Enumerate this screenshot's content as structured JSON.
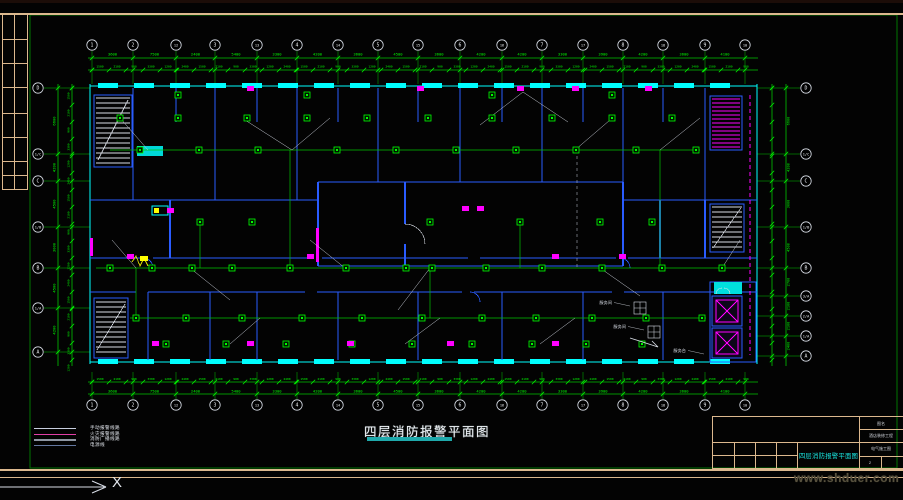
{
  "sheet": {
    "main_title": "四层消防报警平面图",
    "ucs_axis_label": "X",
    "watermark": "www.shduer.com"
  },
  "legend": {
    "items": [
      {
        "label": "手动报警线路",
        "color": "#c7cede"
      },
      {
        "label": "火灾报警线路",
        "color": "#e23fa6"
      },
      {
        "label": "消防广播线路",
        "color": "#8e96a2"
      },
      {
        "label": "电源线",
        "color": "#63779f"
      }
    ]
  },
  "grid": {
    "top": [
      "1",
      "2",
      "12",
      "3",
      "13",
      "4",
      "14",
      "5",
      "15",
      "6",
      "16",
      "7",
      "17",
      "8",
      "18",
      "9",
      "10"
    ],
    "bottom": [
      "1",
      "2",
      "12",
      "3",
      "13",
      "4",
      "14",
      "5",
      "15",
      "6",
      "16",
      "7",
      "17",
      "8",
      "18",
      "9",
      "10"
    ],
    "left": [
      "D",
      "1/C",
      "C",
      "1/B",
      "B",
      "1/A",
      "A"
    ],
    "right": [
      "D",
      "1/C",
      "C",
      "1/B",
      "B",
      "3/A",
      "2/A",
      "1/A",
      "A"
    ]
  },
  "dimensions": {
    "top_major": [
      "3600",
      "7500",
      "2400",
      "5400",
      "3300",
      "4200",
      "3600",
      "4500",
      "3600",
      "4200",
      "4200",
      "3300",
      "3900",
      "4200",
      "3600",
      "4100"
    ],
    "bottom_major": [
      "3600",
      "7500",
      "2400",
      "5400",
      "3300",
      "4200",
      "3600",
      "4500",
      "3600",
      "4200",
      "4200",
      "3300",
      "3900",
      "4200",
      "3600",
      "4100"
    ],
    "left_major": [
      "6600",
      "4200",
      "4500",
      "3000",
      "4500",
      "4200"
    ],
    "right_major": [
      "6600",
      "4200",
      "3000",
      "4500",
      "2700",
      "2100",
      "2100",
      "2400"
    ],
    "minor_cycle": [
      "1500",
      "2100",
      "900",
      "3300",
      "1200",
      "2400"
    ]
  },
  "annotations": [
    "服务间",
    "服务间",
    "服务台"
  ],
  "title_block": {
    "drawing_name": "四层消防报警平面图",
    "field_top": "图名",
    "project": "酒店装修工程",
    "category": "电气施工图",
    "sheet_no": "2"
  }
}
